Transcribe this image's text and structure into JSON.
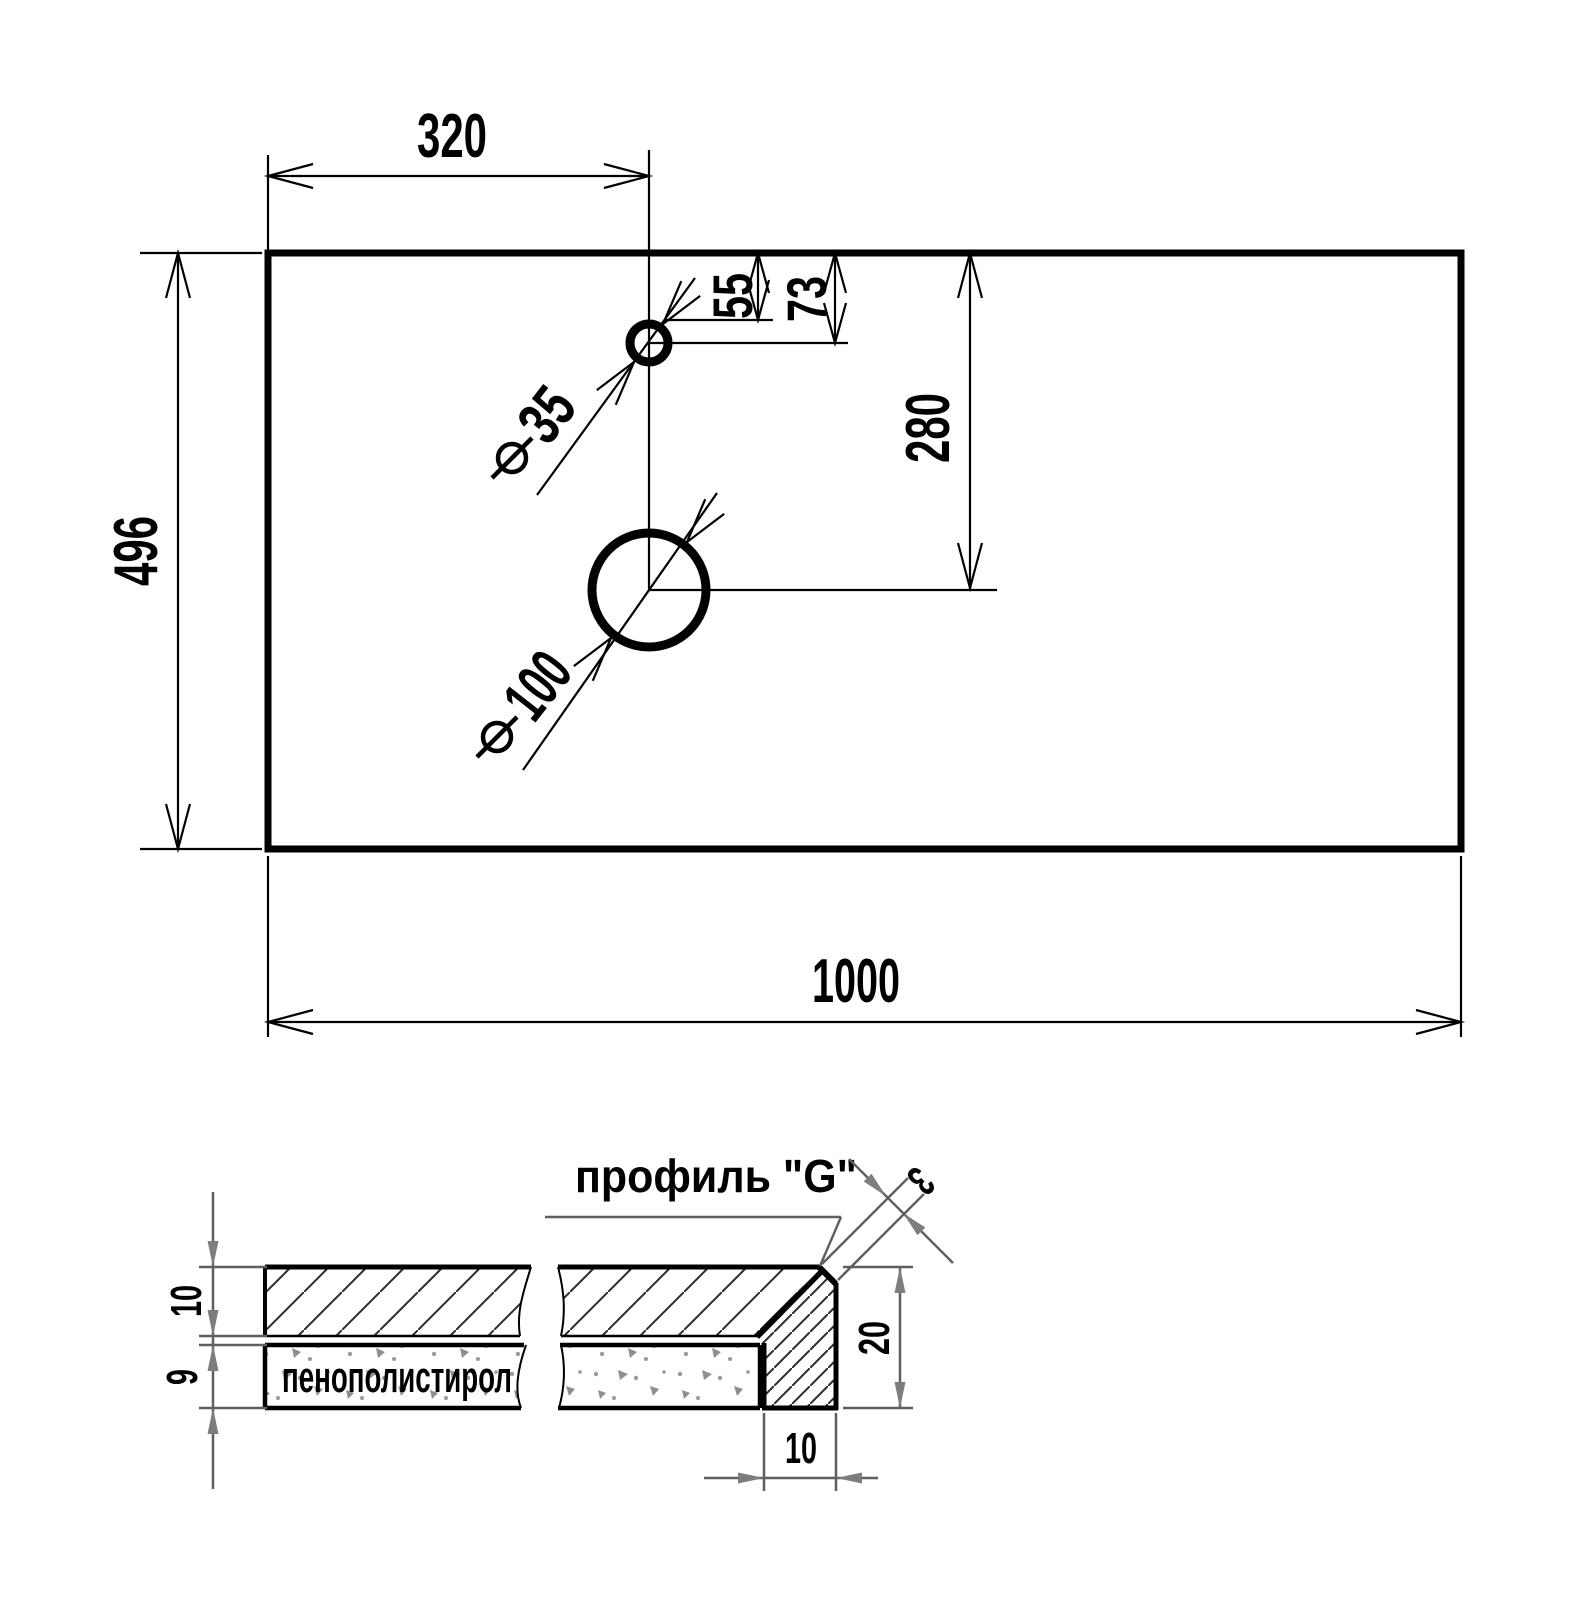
{
  "drawing": {
    "top_view": {
      "dims": {
        "width": "1000",
        "depth": "496",
        "faucet_offset_x": "320",
        "faucet_edge_offset": "55",
        "faucet_center_offset": "73",
        "drain_center_offset": "280"
      },
      "holes": {
        "faucet_diameter": "35",
        "drain_diameter": "100"
      }
    },
    "section_view": {
      "title": "профиль \"G\"",
      "foam_label": "пенополистирол",
      "dims": {
        "top_layer_thickness": "10",
        "foam_thickness": "9",
        "edge_height": "20",
        "edge_leg_width": "10",
        "chamfer": "3"
      }
    },
    "colors": {
      "line": "#000000",
      "dim_gray": "#5f5f5f",
      "arrow_gray": "#7d7d7d",
      "speckle": "#9a9a9a"
    }
  }
}
